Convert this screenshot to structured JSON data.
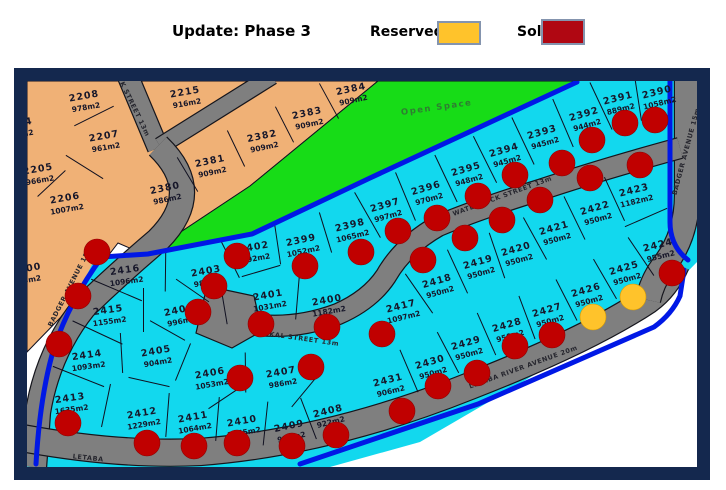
{
  "header": {
    "title": "Update: Phase 3",
    "legend": [
      {
        "label": "Reserved",
        "color": "#FFC32B"
      },
      {
        "label": "Sold",
        "color": "#B00712"
      }
    ]
  },
  "map": {
    "colors": {
      "phase_old": "#F0B176",
      "open_space": "#17DC17",
      "phase_new": "#12D8EE",
      "road": "#7F7F7F",
      "boundary": "#0018E6",
      "frame": "#14284E",
      "outside": "#FFFFFF",
      "sold_dot": "#C00000",
      "reserved_dot": "#FFC32B"
    },
    "open_space_label": "Open Space",
    "streets": [
      {
        "name": "K STREET 13m",
        "x": 133,
        "y": 110,
        "rot": 64
      },
      {
        "name": "BADGER AVENUE 15m",
        "x": 72,
        "y": 287,
        "rot": -63
      },
      {
        "name": "BADGER AVENUE 15m",
        "x": 688,
        "y": 152,
        "rot": -75
      },
      {
        "name": "WATERBUCK STREET 13m",
        "x": 503,
        "y": 198,
        "rot": -20
      },
      {
        "name": "JACKAL STREET 13m",
        "x": 297,
        "y": 340,
        "rot": 8
      },
      {
        "name": "LETABA RIVER AVENUE 20m",
        "x": 524,
        "y": 369,
        "rot": -20
      },
      {
        "name": "LETABA",
        "x": 88,
        "y": 460,
        "rot": 6
      }
    ],
    "lots": [
      {
        "num": "04",
        "size": "m2",
        "x": 25,
        "y": 122,
        "rot": -10
      },
      {
        "num": "2205",
        "size": "966m2",
        "x": 38,
        "y": 169,
        "rot": -10
      },
      {
        "num": "2206",
        "size": "1007m2",
        "x": 65,
        "y": 198,
        "rot": -10
      },
      {
        "num": "2207",
        "size": "961m2",
        "x": 104,
        "y": 136,
        "rot": -10
      },
      {
        "num": "2208",
        "size": "978m2",
        "x": 84,
        "y": 96,
        "rot": -10
      },
      {
        "num": "2215",
        "size": "916m2",
        "x": 185,
        "y": 92,
        "rot": -10
      },
      {
        "num": "200",
        "size": "3m2",
        "x": 30,
        "y": 268,
        "rot": -10
      },
      {
        "num": "2380",
        "size": "986m2",
        "x": 165,
        "y": 188,
        "rot": -12
      },
      {
        "num": "2381",
        "size": "909m2",
        "x": 210,
        "y": 161,
        "rot": -12
      },
      {
        "num": "2382",
        "size": "909m2",
        "x": 262,
        "y": 136,
        "rot": -12
      },
      {
        "num": "2383",
        "size": "909m2",
        "x": 307,
        "y": 113,
        "rot": -12
      },
      {
        "num": "2384",
        "size": "909m2",
        "x": 351,
        "y": 89,
        "rot": -12
      },
      {
        "num": "2390",
        "size": "1058m2",
        "x": 657,
        "y": 92,
        "rot": -14
      },
      {
        "num": "2391",
        "size": "889m2",
        "x": 618,
        "y": 98,
        "rot": -14
      },
      {
        "num": "2392",
        "size": "944m2",
        "x": 584,
        "y": 114,
        "rot": -16
      },
      {
        "num": "2393",
        "size": "945m2",
        "x": 542,
        "y": 132,
        "rot": -16
      },
      {
        "num": "2394",
        "size": "945m2",
        "x": 504,
        "y": 150,
        "rot": -16
      },
      {
        "num": "2395",
        "size": "948m2",
        "x": 466,
        "y": 169,
        "rot": -16
      },
      {
        "num": "2396",
        "size": "970m2",
        "x": 426,
        "y": 188,
        "rot": -16
      },
      {
        "num": "2397",
        "size": "997m2",
        "x": 385,
        "y": 205,
        "rot": -16
      },
      {
        "num": "2398",
        "size": "1065m2",
        "x": 350,
        "y": 225,
        "rot": -14
      },
      {
        "num": "2399",
        "size": "1052m2",
        "x": 301,
        "y": 240,
        "rot": -12
      },
      {
        "num": "2400",
        "size": "1182m2",
        "x": 327,
        "y": 300,
        "rot": -10
      },
      {
        "num": "2401",
        "size": "1031m2",
        "x": 268,
        "y": 295,
        "rot": -10
      },
      {
        "num": "2402",
        "size": "992m2",
        "x": 254,
        "y": 247,
        "rot": -10
      },
      {
        "num": "2403",
        "size": "987m2",
        "x": 206,
        "y": 271,
        "rot": -10
      },
      {
        "num": "2404",
        "size": "996m2",
        "x": 179,
        "y": 310,
        "rot": -12
      },
      {
        "num": "2405",
        "size": "904m2",
        "x": 156,
        "y": 351,
        "rot": -10
      },
      {
        "num": "2406",
        "size": "1053m2",
        "x": 210,
        "y": 373,
        "rot": -10
      },
      {
        "num": "2407",
        "size": "986m2",
        "x": 281,
        "y": 372,
        "rot": -10
      },
      {
        "num": "2408",
        "size": "922m2",
        "x": 328,
        "y": 411,
        "rot": -14
      },
      {
        "num": "2409",
        "size": "927m2",
        "x": 289,
        "y": 426,
        "rot": -12
      },
      {
        "num": "2410",
        "size": "1045m2",
        "x": 242,
        "y": 421,
        "rot": -10
      },
      {
        "num": "2411",
        "size": "1064m2",
        "x": 193,
        "y": 417,
        "rot": -10
      },
      {
        "num": "2412",
        "size": "1229m2",
        "x": 142,
        "y": 413,
        "rot": -10
      },
      {
        "num": "2413",
        "size": "1635m2",
        "x": 70,
        "y": 398,
        "rot": -8
      },
      {
        "num": "2414",
        "size": "1093m2",
        "x": 87,
        "y": 355,
        "rot": -8
      },
      {
        "num": "2415",
        "size": "1155m2",
        "x": 108,
        "y": 310,
        "rot": -8
      },
      {
        "num": "2416",
        "size": "1096m2",
        "x": 125,
        "y": 270,
        "rot": -8
      },
      {
        "num": "2417",
        "size": "1097m2",
        "x": 401,
        "y": 306,
        "rot": -14
      },
      {
        "num": "2418",
        "size": "950m2",
        "x": 437,
        "y": 281,
        "rot": -16
      },
      {
        "num": "2419",
        "size": "950m2",
        "x": 478,
        "y": 262,
        "rot": -16
      },
      {
        "num": "2420",
        "size": "950m2",
        "x": 516,
        "y": 249,
        "rot": -16
      },
      {
        "num": "2421",
        "size": "950m2",
        "x": 554,
        "y": 228,
        "rot": -16
      },
      {
        "num": "2422",
        "size": "950m2",
        "x": 595,
        "y": 208,
        "rot": -16
      },
      {
        "num": "2423",
        "size": "1182m2",
        "x": 634,
        "y": 190,
        "rot": -14
      },
      {
        "num": "2424",
        "size": "955m2",
        "x": 658,
        "y": 245,
        "rot": -14
      },
      {
        "num": "2425",
        "size": "950m2",
        "x": 624,
        "y": 268,
        "rot": -16
      },
      {
        "num": "2426",
        "size": "950m2",
        "x": 586,
        "y": 290,
        "rot": -16
      },
      {
        "num": "2427",
        "size": "950m2",
        "x": 547,
        "y": 310,
        "rot": -16
      },
      {
        "num": "2428",
        "size": "950m2",
        "x": 507,
        "y": 325,
        "rot": -16
      },
      {
        "num": "2429",
        "size": "950m2",
        "x": 466,
        "y": 343,
        "rot": -16
      },
      {
        "num": "2430",
        "size": "950m2",
        "x": 430,
        "y": 362,
        "rot": -16
      },
      {
        "num": "2431",
        "size": "906m2",
        "x": 388,
        "y": 380,
        "rot": -14
      }
    ],
    "dots": {
      "sold": [
        [
          97,
          252
        ],
        [
          78,
          296
        ],
        [
          59,
          344
        ],
        [
          68,
          423
        ],
        [
          147,
          443
        ],
        [
          194,
          446
        ],
        [
          237,
          443
        ],
        [
          292,
          446
        ],
        [
          336,
          435
        ],
        [
          214,
          286
        ],
        [
          198,
          312
        ],
        [
          237,
          256
        ],
        [
          305,
          266
        ],
        [
          261,
          324
        ],
        [
          327,
          327
        ],
        [
          240,
          378
        ],
        [
          311,
          367
        ],
        [
          361,
          252
        ],
        [
          382,
          334
        ],
        [
          398,
          231
        ],
        [
          437,
          218
        ],
        [
          478,
          196
        ],
        [
          515,
          175
        ],
        [
          562,
          163
        ],
        [
          592,
          140
        ],
        [
          625,
          123
        ],
        [
          655,
          120
        ],
        [
          640,
          165
        ],
        [
          590,
          178
        ],
        [
          540,
          200
        ],
        [
          502,
          220
        ],
        [
          465,
          238
        ],
        [
          423,
          260
        ],
        [
          672,
          273
        ],
        [
          552,
          335
        ],
        [
          515,
          346
        ],
        [
          477,
          373
        ],
        [
          438,
          386
        ],
        [
          402,
          411
        ]
      ],
      "reserved": [
        [
          593,
          317
        ],
        [
          633,
          297
        ]
      ]
    }
  }
}
